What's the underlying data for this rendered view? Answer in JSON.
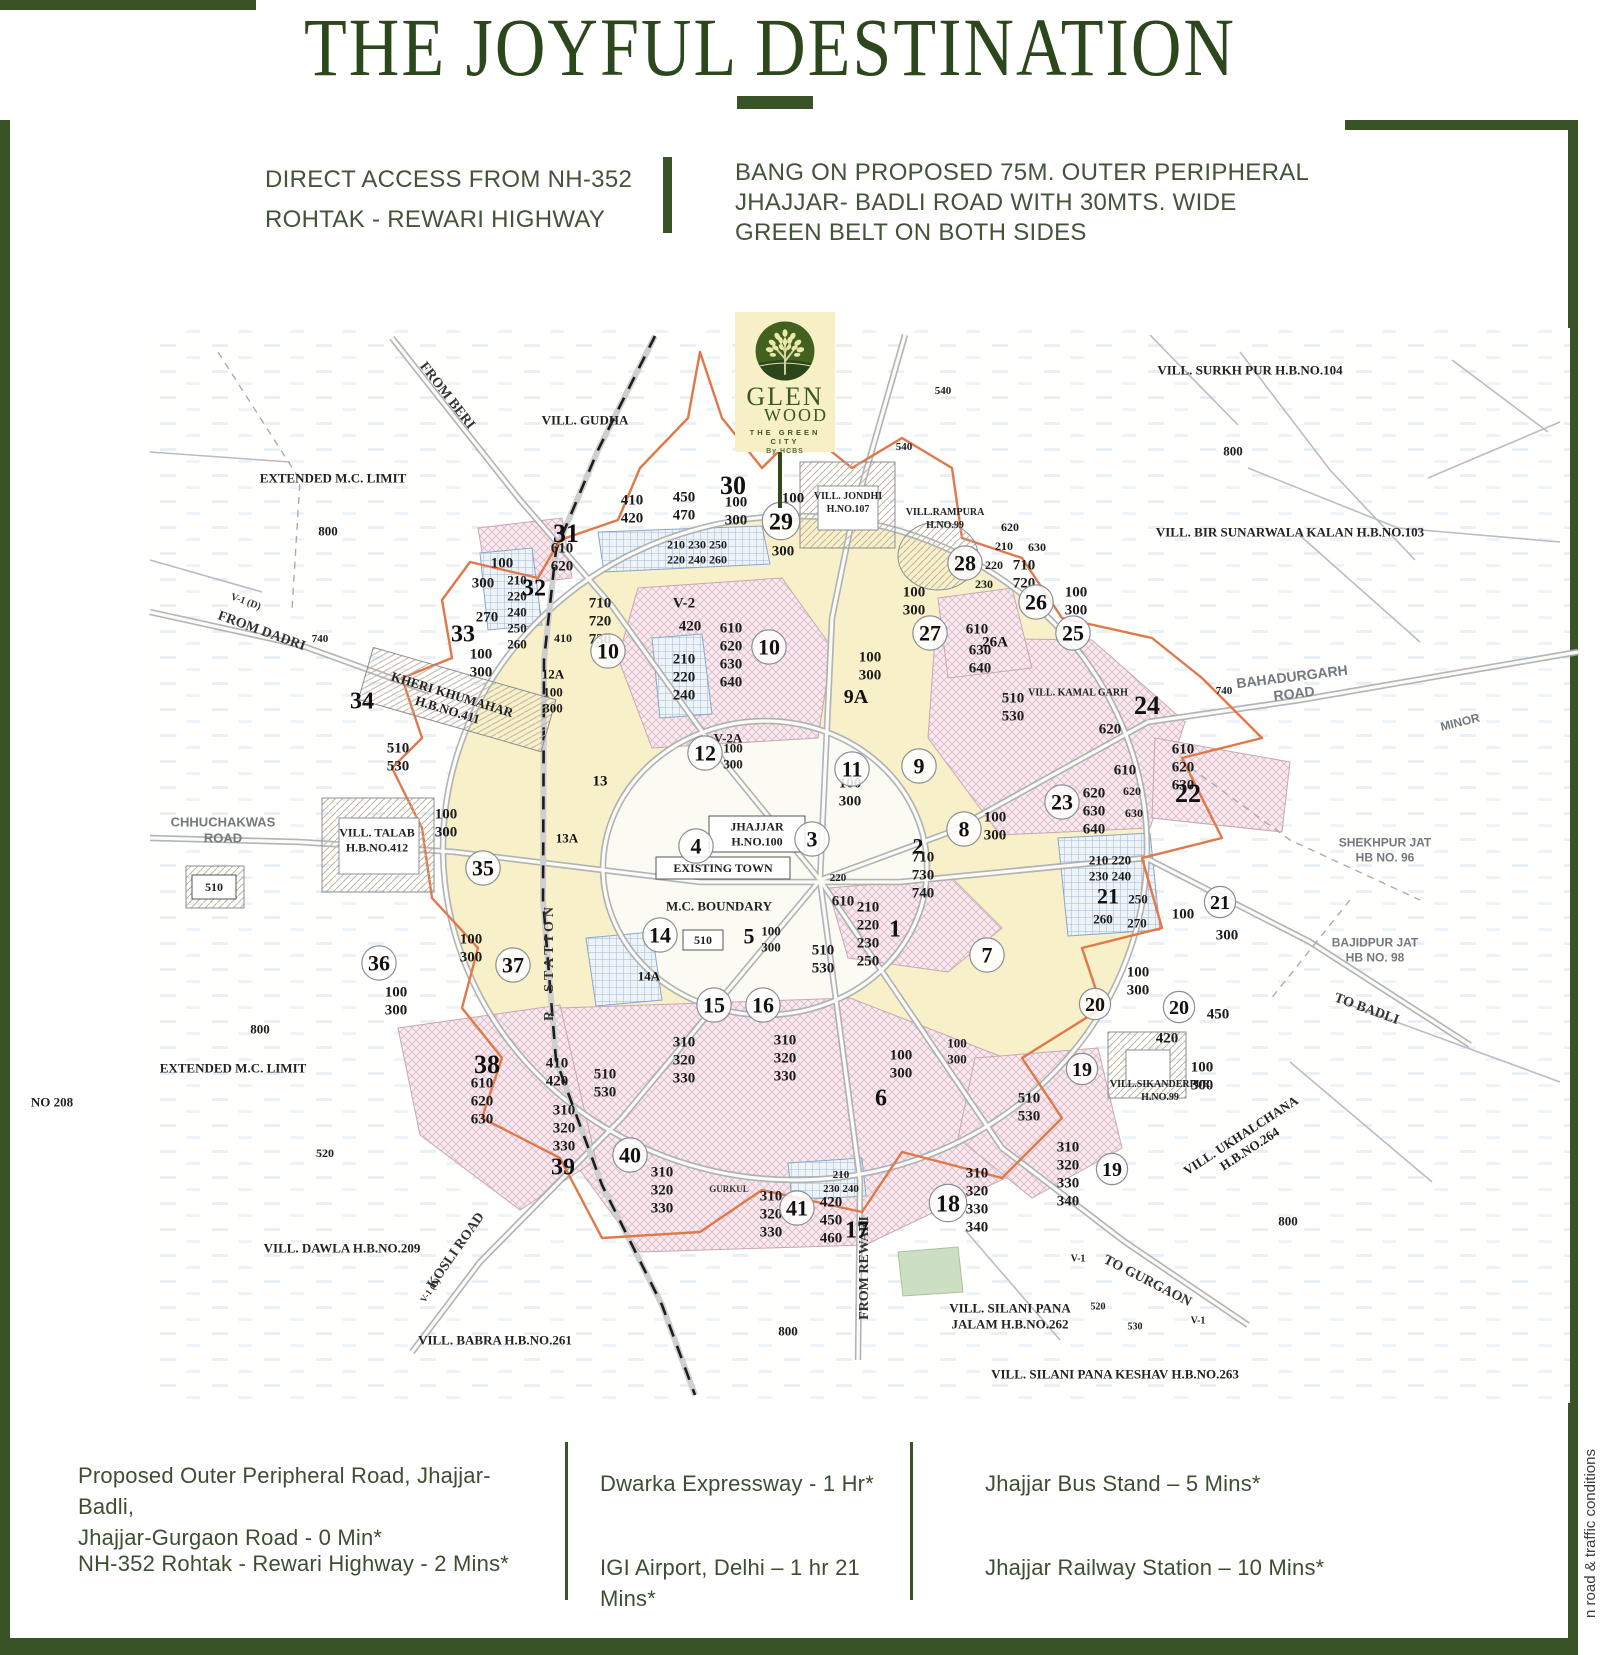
{
  "title": "THE JOYFUL DESTINATION",
  "intro": {
    "left": "DIRECT ACCESS FROM NH-352\nROHTAK - REWARI HIGHWAY",
    "right": "BANG ON PROPOSED 75M. OUTER PERIPHERAL\nJHAJJAR- BADLI ROAD WITH 30MTS. WIDE\nGREEN BELT ON BOTH SIDES"
  },
  "logo": {
    "name_top": "GLEN",
    "name_bottom": "WOOD",
    "tagline": "THE GREEN CITY",
    "by": "By HCBS"
  },
  "distances": {
    "col1": [
      "Proposed Outer Peripheral Road, Jhajjar- Badli,\nJhajjar-Gurgaon Road - 0 Min*",
      "NH-352 Rohtak - Rewari Highway - 2 Mins*"
    ],
    "col2": [
      "Dwarka Expressway - 1 Hr*",
      "IGI Airport, Delhi – 1 hr 21 Mins*"
    ],
    "col3": [
      "Jhajjar Bus Stand – 5 Mins*",
      "Jhajjar Railway Station – 10 Mins*"
    ]
  },
  "side_note": "n road & traffic conditions",
  "colors": {
    "frame_green": "#3a5326",
    "title_green": "#2c471c",
    "map_yellow": "#f7f0c8",
    "map_pink": "#f6e9ee",
    "map_blue": "#c7d7e8",
    "boundary_orange": "#e0784a",
    "logo_bg": "#f6f0c4",
    "logo_green": "#3a5723"
  },
  "map": {
    "sectors": [
      {
        "n": "30",
        "x": 733,
        "y": 485,
        "s": 26
      },
      {
        "n": "29",
        "x": 781,
        "y": 521,
        "s": 24,
        "c": 1
      },
      {
        "n": "31",
        "x": 566,
        "y": 533,
        "s": 26
      },
      {
        "n": "32",
        "x": 534,
        "y": 587,
        "s": 24
      },
      {
        "n": "33",
        "x": 463,
        "y": 633,
        "s": 24
      },
      {
        "n": "34",
        "x": 362,
        "y": 700,
        "s": 24
      },
      {
        "n": "35",
        "x": 483,
        "y": 868,
        "s": 22,
        "c": 1
      },
      {
        "n": "36",
        "x": 379,
        "y": 963,
        "s": 22,
        "c": 1
      },
      {
        "n": "37",
        "x": 513,
        "y": 965,
        "s": 22,
        "c": 1
      },
      {
        "n": "38",
        "x": 487,
        "y": 1064,
        "s": 26
      },
      {
        "n": "39",
        "x": 563,
        "y": 1166,
        "s": 24
      },
      {
        "n": "40",
        "x": 630,
        "y": 1155,
        "s": 22,
        "c": 1
      },
      {
        "n": "41",
        "x": 797,
        "y": 1208,
        "s": 22,
        "c": 1
      },
      {
        "n": "28",
        "x": 965,
        "y": 563,
        "s": 22,
        "c": 1
      },
      {
        "n": "27",
        "x": 930,
        "y": 633,
        "s": 22,
        "c": 1
      },
      {
        "n": "26",
        "x": 1036,
        "y": 602,
        "s": 22,
        "c": 1
      },
      {
        "n": "26A",
        "x": 995,
        "y": 641,
        "s": 15
      },
      {
        "n": "25",
        "x": 1073,
        "y": 633,
        "s": 22,
        "c": 1
      },
      {
        "n": "24",
        "x": 1147,
        "y": 705,
        "s": 26
      },
      {
        "n": "23",
        "x": 1062,
        "y": 802,
        "s": 22,
        "c": 1
      },
      {
        "n": "22",
        "x": 1188,
        "y": 793,
        "s": 26
      },
      {
        "n": "21",
        "x": 1108,
        "y": 896,
        "s": 22
      },
      {
        "n": "21",
        "x": 1220,
        "y": 902,
        "s": 20,
        "c": 1
      },
      {
        "n": "20",
        "x": 1095,
        "y": 1004,
        "s": 20,
        "c": 1
      },
      {
        "n": "20",
        "x": 1179,
        "y": 1007,
        "s": 20,
        "c": 1
      },
      {
        "n": "19",
        "x": 1082,
        "y": 1069,
        "s": 20,
        "c": 1
      },
      {
        "n": "19",
        "x": 1112,
        "y": 1169,
        "s": 20,
        "c": 1
      },
      {
        "n": "18",
        "x": 948,
        "y": 1203,
        "s": 24,
        "c": 1
      },
      {
        "n": "17",
        "x": 857,
        "y": 1229,
        "s": 24
      },
      {
        "n": "16",
        "x": 763,
        "y": 1005,
        "s": 22,
        "c": 1
      },
      {
        "n": "15",
        "x": 714,
        "y": 1005,
        "s": 22,
        "c": 1
      },
      {
        "n": "14",
        "x": 660,
        "y": 935,
        "s": 22,
        "c": 1
      },
      {
        "n": "14A",
        "x": 649,
        "y": 976,
        "s": 13
      },
      {
        "n": "13",
        "x": 600,
        "y": 780,
        "s": 15
      },
      {
        "n": "13A",
        "x": 567,
        "y": 838,
        "s": 13
      },
      {
        "n": "12",
        "x": 705,
        "y": 753,
        "s": 22,
        "c": 1
      },
      {
        "n": "12A",
        "x": 553,
        "y": 674,
        "s": 13
      },
      {
        "n": "10",
        "x": 608,
        "y": 651,
        "s": 22,
        "c": 1
      },
      {
        "n": "10",
        "x": 769,
        "y": 647,
        "s": 22,
        "c": 1
      },
      {
        "n": "9A",
        "x": 856,
        "y": 696,
        "s": 20
      },
      {
        "n": "9",
        "x": 919,
        "y": 766,
        "s": 22,
        "c": 1
      },
      {
        "n": "11",
        "x": 852,
        "y": 769,
        "s": 22,
        "c": 1
      },
      {
        "n": "8",
        "x": 964,
        "y": 829,
        "s": 22,
        "c": 1
      },
      {
        "n": "7",
        "x": 987,
        "y": 955,
        "s": 22,
        "c": 1
      },
      {
        "n": "6",
        "x": 881,
        "y": 1097,
        "s": 24
      },
      {
        "n": "5",
        "x": 749,
        "y": 936,
        "s": 22
      },
      {
        "n": "4",
        "x": 696,
        "y": 846,
        "s": 22,
        "c": 1
      },
      {
        "n": "3",
        "x": 812,
        "y": 839,
        "s": 22,
        "c": 1
      },
      {
        "n": "2",
        "x": 918,
        "y": 846,
        "s": 22
      },
      {
        "n": "1",
        "x": 895,
        "y": 928,
        "s": 24
      }
    ],
    "plots": [
      {
        "t": "410\n420",
        "x": 632,
        "y": 508
      },
      {
        "t": "450\n470",
        "x": 684,
        "y": 505
      },
      {
        "t": "100\n300",
        "x": 736,
        "y": 510
      },
      {
        "t": "100",
        "x": 793,
        "y": 497
      },
      {
        "t": "300",
        "x": 783,
        "y": 550
      },
      {
        "t": "610\n620",
        "x": 562,
        "y": 556
      },
      {
        "t": "100",
        "x": 502,
        "y": 562
      },
      {
        "t": "300",
        "x": 483,
        "y": 582
      },
      {
        "t": "210\n220\n240\n250\n260",
        "x": 517,
        "y": 612,
        "s": 13
      },
      {
        "t": "270",
        "x": 487,
        "y": 616
      },
      {
        "t": "410",
        "x": 563,
        "y": 638,
        "s": 12
      },
      {
        "t": "100\n300",
        "x": 481,
        "y": 662
      },
      {
        "t": "210  230  250\n220  240  260",
        "x": 697,
        "y": 552,
        "s": 12
      },
      {
        "t": "710\n720\n730",
        "x": 600,
        "y": 620
      },
      {
        "t": "V-2",
        "x": 684,
        "y": 602
      },
      {
        "t": "420",
        "x": 690,
        "y": 625
      },
      {
        "t": "610\n620\n630\n640",
        "x": 731,
        "y": 654
      },
      {
        "t": "210\n220\n240",
        "x": 684,
        "y": 676
      },
      {
        "t": "100\n300",
        "x": 553,
        "y": 700,
        "s": 13
      },
      {
        "t": "V-2A",
        "x": 728,
        "y": 738,
        "s": 13
      },
      {
        "t": "100\n300",
        "x": 733,
        "y": 756,
        "s": 13
      },
      {
        "t": "100\n300",
        "x": 914,
        "y": 600
      },
      {
        "t": "710\n720",
        "x": 1024,
        "y": 573
      },
      {
        "t": "100\n300",
        "x": 1076,
        "y": 600
      },
      {
        "t": "620",
        "x": 1010,
        "y": 527,
        "s": 12
      },
      {
        "t": "210",
        "x": 1004,
        "y": 546,
        "s": 12
      },
      {
        "t": "630",
        "x": 1037,
        "y": 547,
        "s": 12
      },
      {
        "t": "220",
        "x": 994,
        "y": 565,
        "s": 12
      },
      {
        "t": "230",
        "x": 984,
        "y": 584,
        "s": 12
      },
      {
        "t": "610",
        "x": 977,
        "y": 628
      },
      {
        "t": "630\n640",
        "x": 980,
        "y": 658
      },
      {
        "t": "540",
        "x": 943,
        "y": 390,
        "s": 11
      },
      {
        "t": "540",
        "x": 904,
        "y": 446,
        "s": 11
      },
      {
        "t": "800",
        "x": 328,
        "y": 531,
        "s": 13
      },
      {
        "t": "800",
        "x": 1233,
        "y": 451,
        "s": 13
      },
      {
        "t": "800",
        "x": 260,
        "y": 1029,
        "s": 13
      },
      {
        "t": "800",
        "x": 788,
        "y": 1331,
        "s": 13
      },
      {
        "t": "800",
        "x": 1288,
        "y": 1221,
        "s": 13
      },
      {
        "t": "740",
        "x": 320,
        "y": 638,
        "s": 11
      },
      {
        "t": "740",
        "x": 1224,
        "y": 690,
        "s": 11
      },
      {
        "t": "510\n530",
        "x": 398,
        "y": 756
      },
      {
        "t": "100\n300",
        "x": 446,
        "y": 822
      },
      {
        "t": "100\n300",
        "x": 471,
        "y": 947
      },
      {
        "t": "100\n300",
        "x": 396,
        "y": 1000
      },
      {
        "t": "520",
        "x": 325,
        "y": 1153,
        "s": 12
      },
      {
        "t": "410\n420",
        "x": 557,
        "y": 1071
      },
      {
        "t": "610\n620\n630",
        "x": 482,
        "y": 1100
      },
      {
        "t": "310\n320\n330",
        "x": 564,
        "y": 1127
      },
      {
        "t": "510\n530",
        "x": 605,
        "y": 1082
      },
      {
        "t": "310\n320\n330",
        "x": 684,
        "y": 1059
      },
      {
        "t": "310\n320\n330",
        "x": 785,
        "y": 1057
      },
      {
        "t": "310\n320\n330",
        "x": 662,
        "y": 1189
      },
      {
        "t": "310\n320\n330",
        "x": 771,
        "y": 1213
      },
      {
        "t": "420\n450\n460",
        "x": 831,
        "y": 1219
      },
      {
        "t": "210\n230 240",
        "x": 841,
        "y": 1181,
        "s": 11
      },
      {
        "t": "100\n300",
        "x": 901,
        "y": 1063
      },
      {
        "t": "310\n320\n330\n340",
        "x": 977,
        "y": 1199
      },
      {
        "t": "310\n320\n330\n340",
        "x": 1068,
        "y": 1173
      },
      {
        "t": "510\n530",
        "x": 1029,
        "y": 1106
      },
      {
        "t": "100\n300",
        "x": 1138,
        "y": 980
      },
      {
        "t": "450",
        "x": 1218,
        "y": 1013
      },
      {
        "t": "420",
        "x": 1167,
        "y": 1037
      },
      {
        "t": "100\n300",
        "x": 1202,
        "y": 1075
      },
      {
        "t": "210  220\n230  240",
        "x": 1110,
        "y": 868,
        "s": 13
      },
      {
        "t": "250",
        "x": 1138,
        "y": 899,
        "s": 13
      },
      {
        "t": "260",
        "x": 1103,
        "y": 919,
        "s": 13
      },
      {
        "t": "270",
        "x": 1137,
        "y": 923,
        "s": 13
      },
      {
        "t": "100",
        "x": 1183,
        "y": 913
      },
      {
        "t": "300",
        "x": 1227,
        "y": 934
      },
      {
        "t": "510\n530",
        "x": 1013,
        "y": 706
      },
      {
        "t": "620",
        "x": 1110,
        "y": 728
      },
      {
        "t": "610",
        "x": 1125,
        "y": 769
      },
      {
        "t": "620\n630\n640",
        "x": 1094,
        "y": 810
      },
      {
        "t": "620",
        "x": 1132,
        "y": 791,
        "s": 12
      },
      {
        "t": "630",
        "x": 1134,
        "y": 813,
        "s": 12
      },
      {
        "t": "610\n620\n630",
        "x": 1183,
        "y": 766
      },
      {
        "t": "710\n730\n740",
        "x": 923,
        "y": 874
      },
      {
        "t": "220",
        "x": 838,
        "y": 877,
        "s": 11
      },
      {
        "t": "610",
        "x": 843,
        "y": 900
      },
      {
        "t": "210\n220\n230\n250",
        "x": 868,
        "y": 933
      },
      {
        "t": "510\n530",
        "x": 823,
        "y": 958
      },
      {
        "t": "100\n300",
        "x": 771,
        "y": 939,
        "s": 13
      },
      {
        "t": "100\n300",
        "x": 850,
        "y": 791
      },
      {
        "t": "100\n300",
        "x": 995,
        "y": 825
      },
      {
        "t": "100\n300",
        "x": 870,
        "y": 665
      },
      {
        "t": "100\n300",
        "x": 957,
        "y": 1051,
        "s": 13
      },
      {
        "t": "520",
        "x": 1098,
        "y": 1306,
        "s": 10
      },
      {
        "t": "530",
        "x": 1135,
        "y": 1326,
        "s": 10
      },
      {
        "t": "V-1",
        "x": 1198,
        "y": 1320,
        "s": 10
      },
      {
        "t": "V-1",
        "x": 1078,
        "y": 1258,
        "s": 10
      }
    ],
    "villages": [
      {
        "t": "VILL. GUDHA",
        "x": 585,
        "y": 420
      },
      {
        "t": "VILL. SURKH PUR   H.B.NO.104",
        "x": 1250,
        "y": 370
      },
      {
        "t": "VILL. BIR SUNARWALA  KALAN   H.B.NO.103",
        "x": 1290,
        "y": 532
      },
      {
        "t": "EXTENDED M.C. LIMIT",
        "x": 333,
        "y": 478
      },
      {
        "t": "EXTENDED M.C. LIMIT",
        "x": 233,
        "y": 1068
      },
      {
        "t": "NO 208",
        "x": 52,
        "y": 1102
      },
      {
        "t": "VILL. DAWLA   H.B.NO.209",
        "x": 342,
        "y": 1248
      },
      {
        "t": "VILL. BABRA   H.B.NO.261",
        "x": 495,
        "y": 1340
      },
      {
        "t": "VILL. SILANI PANA\nJALAM H.B.NO.262",
        "x": 1010,
        "y": 1316
      },
      {
        "t": "VILL. SILANI PANA KESHAV  H.B.NO.263",
        "x": 1115,
        "y": 1374
      },
      {
        "t": "VILL. UKHALCHANA\nH.B.NO.264",
        "x": 1245,
        "y": 1142,
        "r": -33
      },
      {
        "t": "VILL.SIKANDERPUR\nH.NO.99",
        "x": 1160,
        "y": 1090,
        "s": 10
      },
      {
        "t": "SHEKHPUR JAT\nHB NO. 96",
        "x": 1385,
        "y": 850,
        "s": 12,
        "sans": 1
      },
      {
        "t": "BAJIDPUR JAT\nHB NO. 98",
        "x": 1375,
        "y": 950,
        "s": 12,
        "sans": 1
      },
      {
        "t": "VILL.RAMPURA\nH.NO.99",
        "x": 945,
        "y": 518,
        "s": 10
      },
      {
        "t": "VILL. JONDHI\nH.NO.107",
        "x": 848,
        "y": 502,
        "s": 10
      },
      {
        "t": "VILL. KAMAL GARH",
        "x": 1078,
        "y": 692,
        "s": 10
      },
      {
        "t": "VILL. TALAB\nH.B.NO.412",
        "x": 377,
        "y": 840,
        "s": 12
      },
      {
        "t": "KHERI KHUMAHAR\nH.B.NO.411",
        "x": 450,
        "y": 702,
        "r": 17
      },
      {
        "t": "M.C. BOUNDARY",
        "x": 719,
        "y": 906
      }
    ],
    "road_labels": [
      {
        "t": "FROM BERI",
        "x": 448,
        "y": 395,
        "r": 52
      },
      {
        "t": "FROM DADRI",
        "x": 262,
        "y": 630,
        "r": 20
      },
      {
        "t": "V-1 (D)",
        "x": 246,
        "y": 601,
        "r": 20,
        "s": 10
      },
      {
        "t": "BAHADURGARH\nROAD",
        "x": 1293,
        "y": 685,
        "r": -7,
        "s": 14,
        "sans": 1
      },
      {
        "t": "MINOR",
        "x": 1460,
        "y": 722,
        "r": -14,
        "s": 12,
        "sans": 1
      },
      {
        "t": "TO BADLI",
        "x": 1367,
        "y": 1008,
        "r": 20
      },
      {
        "t": "TO GURGAON",
        "x": 1148,
        "y": 1280,
        "r": 27
      },
      {
        "t": "FROM REWARI",
        "x": 863,
        "y": 1268,
        "r": -90
      },
      {
        "t": "KOSLI ROAD",
        "x": 455,
        "y": 1250,
        "r": -55
      },
      {
        "t": "V-1 (B)",
        "x": 430,
        "y": 1290,
        "r": -55,
        "s": 9
      },
      {
        "t": "GURKUL",
        "x": 729,
        "y": 1189,
        "s": 9
      },
      {
        "t": "CHHUCHAKWAS\nROAD",
        "x": 223,
        "y": 830,
        "s": 13,
        "sans": 1
      },
      {
        "t": "R. STATION",
        "x": 548,
        "y": 962,
        "r": -90,
        "s": 14,
        "sp": 4
      }
    ],
    "boxed": [
      {
        "t": "JHAJJAR\nH.NO.100",
        "x": 757,
        "y": 834,
        "w": 96,
        "h": 36
      },
      {
        "t": "EXISTING TOWN",
        "x": 723,
        "y": 868,
        "w": 134,
        "h": 22
      },
      {
        "t": "510",
        "x": 703,
        "y": 940,
        "w": 40,
        "h": 20
      },
      {
        "t": "510",
        "x": 214,
        "y": 887,
        "w": 44,
        "h": 24
      }
    ]
  }
}
